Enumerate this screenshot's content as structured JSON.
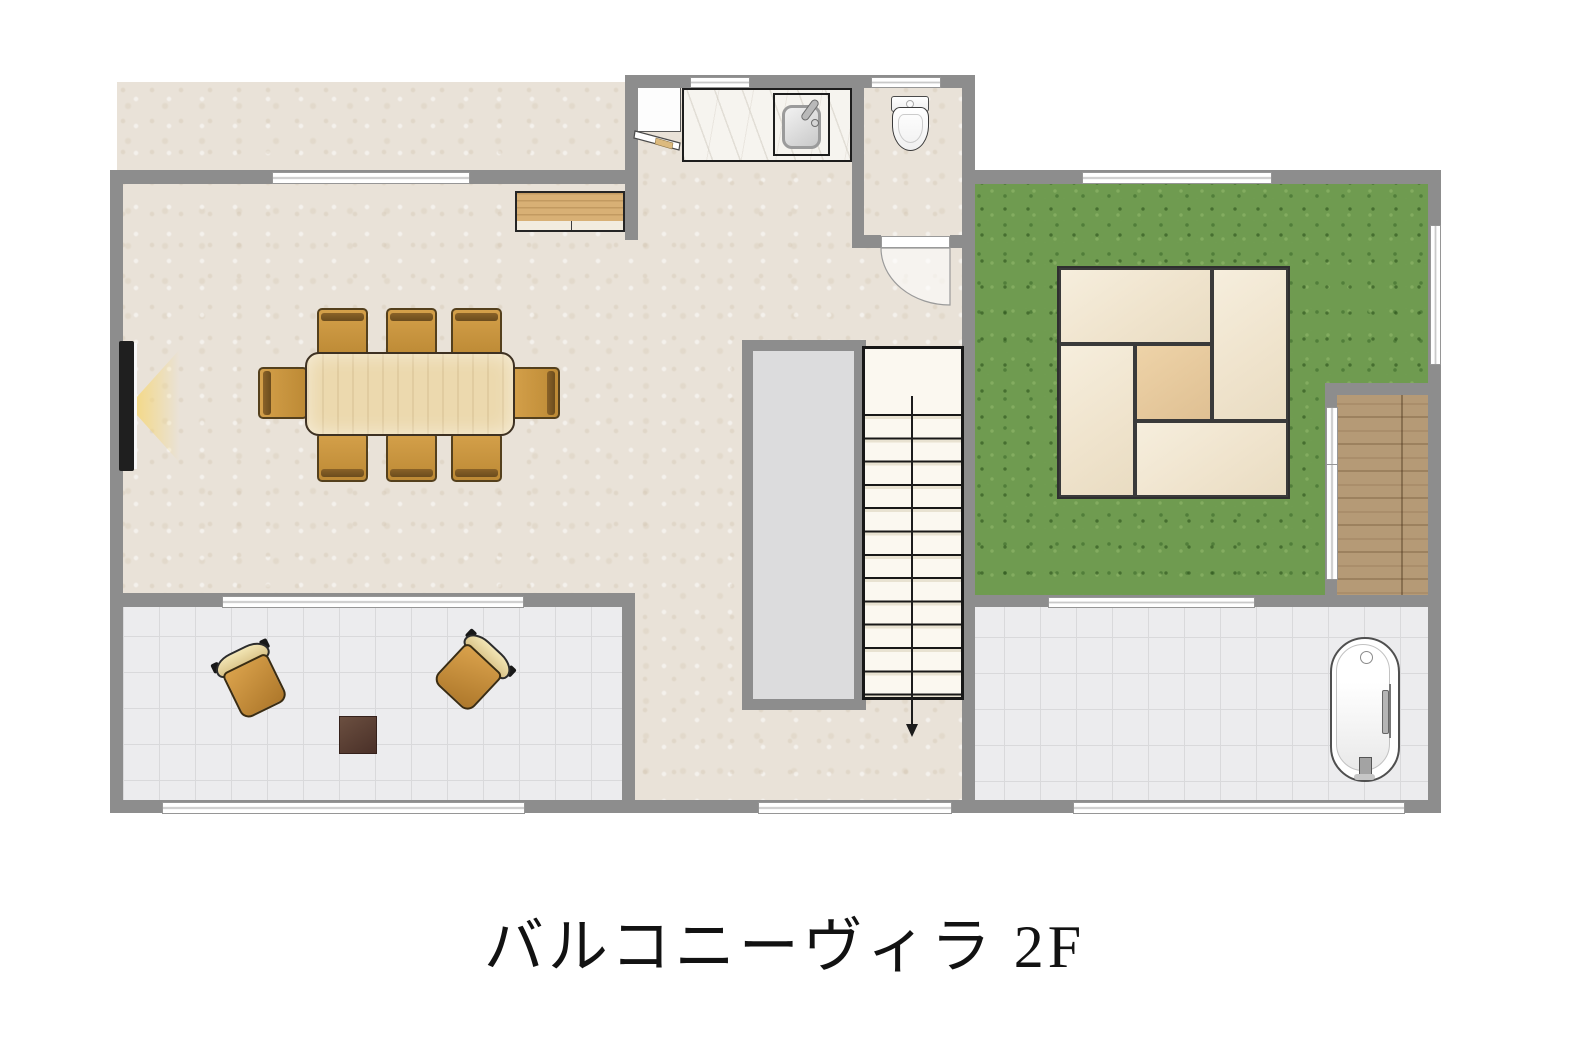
{
  "title": "バルコニーヴィラ 2F",
  "floor_label": "2F",
  "counts": {
    "dining_chairs": 8,
    "balcony_chairs": 2,
    "stair_steps": 13,
    "tatami_mats": 5
  },
  "colors": {
    "wall": "#8d8d8d",
    "floor_beige": "#e9e2d8",
    "grass_green": "#6f9b50",
    "tile": "#ececee",
    "wood": "#b59a76",
    "tatami_mat": "#f6eedd",
    "tatami_center": "#eed3a8",
    "table_wood": "#ecd9ae",
    "stair_fill": "#fbf8f0",
    "title_color": "#121212"
  }
}
